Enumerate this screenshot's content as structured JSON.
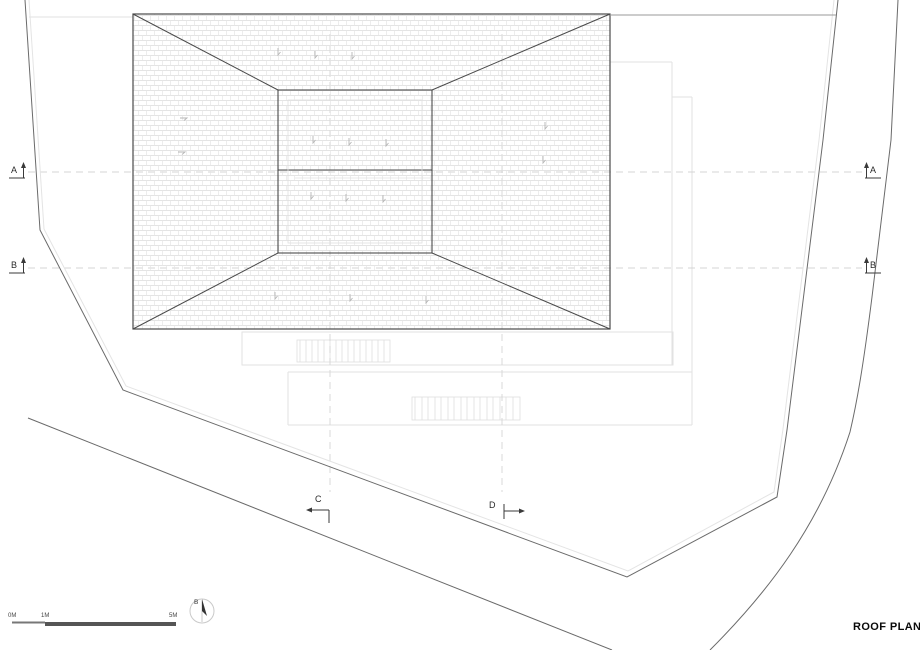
{
  "drawing": {
    "title": "ROOF PLAN"
  },
  "section_markers": {
    "left_a": "A",
    "left_b": "B",
    "right_a": "A",
    "right_b": "B",
    "bottom_c": "C",
    "bottom_d": "D"
  },
  "scale_bar": {
    "labels": [
      "0M",
      "1M",
      "5M"
    ]
  },
  "north_arrow": {
    "label": "B"
  },
  "colors": {
    "background": "#ffffff",
    "roof_line": "#4a4a4a",
    "boundary_line": "#6a6a6a",
    "faint_line": "#e2e2e2",
    "grid_dashed": "#d4d4d4",
    "hatch": "#dcdcdc",
    "text": "#2a2a2a"
  }
}
